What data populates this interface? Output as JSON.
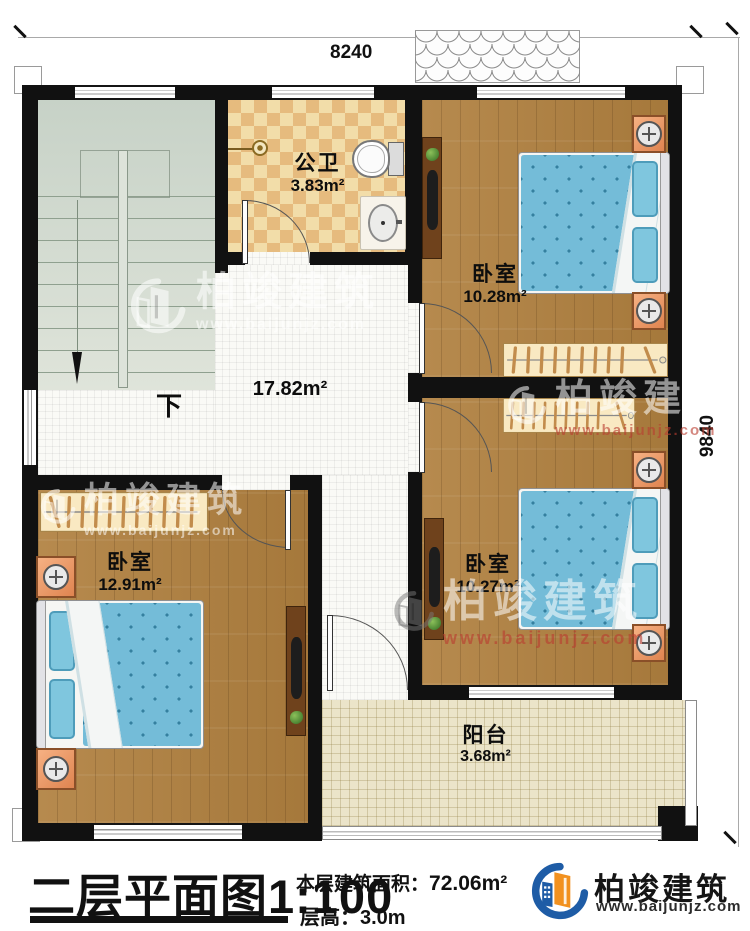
{
  "dimensions": {
    "top": "8240",
    "right": "9840"
  },
  "brand": {
    "name": "柏竣建筑",
    "website": "www.baijunjz.com"
  },
  "rooms": {
    "bathroom": {
      "name": "公卫",
      "area": "3.83m²"
    },
    "bedroom_top_right": {
      "name": "卧室",
      "area": "10.28m²"
    },
    "bedroom_bottom_right": {
      "name": "卧室",
      "area": "10.27m²"
    },
    "bedroom_bottom_left": {
      "name": "卧室",
      "area": "12.91m²"
    },
    "hall": {
      "area": "17.82m²"
    },
    "balcony": {
      "name": "阳台",
      "area": "3.68m²"
    }
  },
  "stairs": {
    "down_label": "下"
  },
  "footer": {
    "title": "二层平面图",
    "scale": "1:100",
    "area_label": "本层建筑面积：",
    "area_value": "72.06m²",
    "floor_height_label": "层高：",
    "floor_height_value": "3.0m"
  },
  "colors": {
    "wall": "#111111",
    "wood_floor": "#b0803f",
    "bathroom_tile_light": "#f2dda9",
    "bathroom_tile_dark": "#e6bb7e",
    "bed_blue": "#74bcd8",
    "stairs_green": "#d0dacf",
    "balcony_tile": "#ebe4c9",
    "nightstand_orange": "#f0a070",
    "logo_blue": "#1e5ca6",
    "logo_orange": "#f2911f",
    "watermark_red": "#b93e30"
  }
}
